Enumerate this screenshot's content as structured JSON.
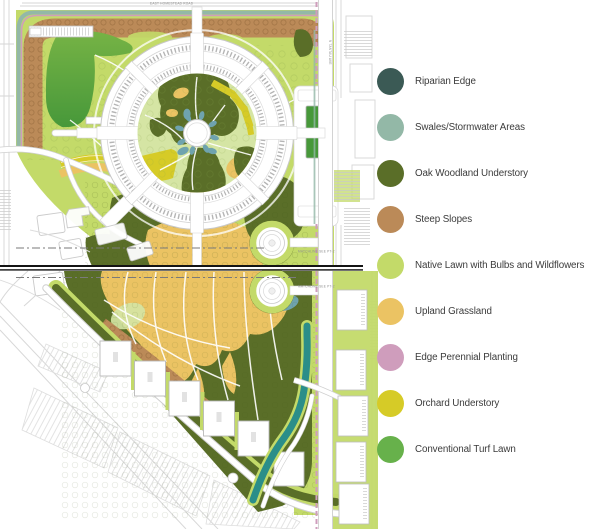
{
  "page": {
    "background": "#ffffff"
  },
  "legend": {
    "items": [
      {
        "label": "Riparian Edge",
        "color_key": "riparian_edge"
      },
      {
        "label": "Swales/Stormwater Areas",
        "color_key": "swales_stormwater"
      },
      {
        "label": "Oak Woodland Understory",
        "color_key": "oak_woodland"
      },
      {
        "label": "Steep Slopes",
        "color_key": "steep_slopes"
      },
      {
        "label": "Native Lawn with Bulbs and Wildflowers",
        "color_key": "native_lawn"
      },
      {
        "label": "Upland Grassland",
        "color_key": "upland_grassland"
      },
      {
        "label": "Edge Perennial Planting",
        "color_key": "edge_perennial"
      },
      {
        "label": "Orchard Understory",
        "color_key": "orchard_understory"
      },
      {
        "label": "Conventional Turf Lawn",
        "color_key": "turf_lawn"
      }
    ]
  },
  "colors": {
    "riparian_edge": "#3b5a55",
    "swales_stormwater": "#93b8a7",
    "oak_woodland": "#5a6e28",
    "steep_slopes": "#bb8a58",
    "native_lawn": "#c3da69",
    "upland_grassland": "#ebc363",
    "edge_perennial": "#cf9dbc",
    "orchard_understory": "#d6cb27",
    "turf_lawn": "#67b14b",
    "pale_lawn": "#d5e5a4",
    "pond_blue": "#6fa3ae",
    "creek_teal": "#2b8e89",
    "turf_field_light": "#76b345",
    "turf_field_dark": "#47983a",
    "plan_linework": "#d6d6d6",
    "building_outline": "#b9b9b9",
    "matchline_black": "#141414",
    "legend_text": "#3b3b3b",
    "tiny_label": "#8f8f8f"
  },
  "map": {
    "labels": {
      "homestead_road": "EAST HOMESTEAD ROAD",
      "tantau_avenue": "N TANTAU AVE",
      "matchline_top": "MATCHLINE SEE PT-2",
      "matchline_bottom": "MATCHLINE SEE PT-2"
    }
  }
}
